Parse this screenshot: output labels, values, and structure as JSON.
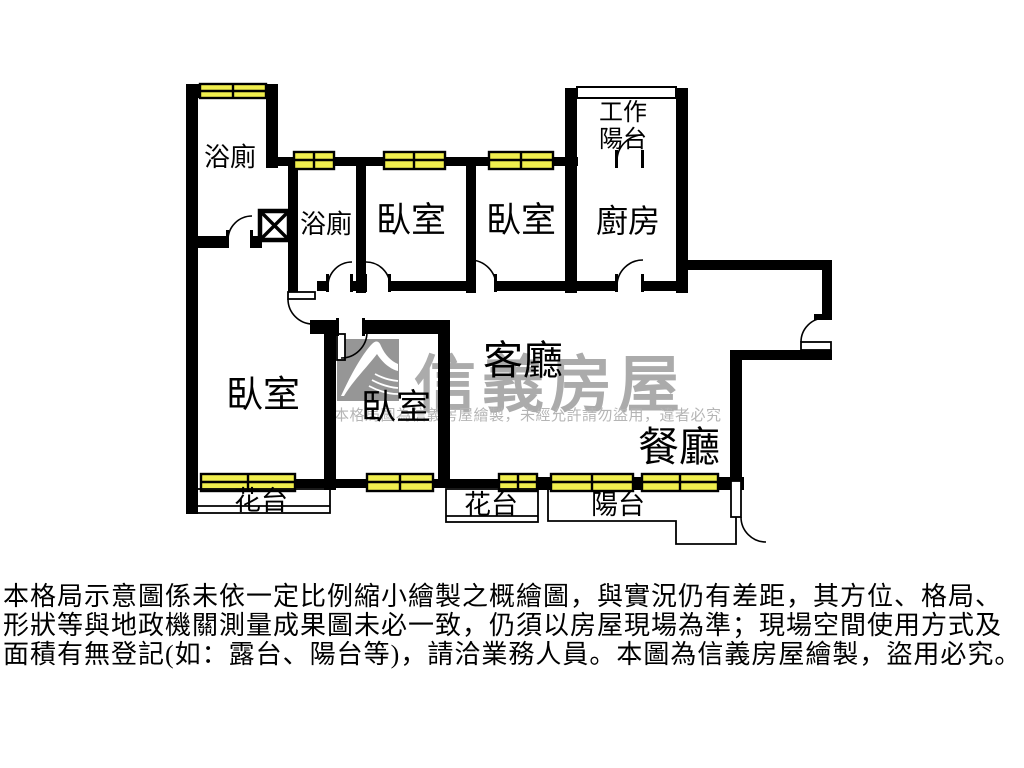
{
  "colors": {
    "wall": "#000000",
    "window_fill": "#f0ee4e",
    "logo_gray": "#969696",
    "watermark_gray": "#ababab",
    "notice_gray": "#b5b5b5",
    "text": "#000000",
    "bg": "#ffffff"
  },
  "rooms": {
    "bath_top": {
      "label": "浴廁"
    },
    "bath_small": {
      "label": "浴廁"
    },
    "bedroom_top_1": {
      "label": "臥室"
    },
    "bedroom_top_2": {
      "label": "臥室"
    },
    "kitchen": {
      "label": "廚房"
    },
    "work_balcony": {
      "label": "工作陽台"
    },
    "living": {
      "label": "客廳"
    },
    "dining": {
      "label": "餐廳"
    },
    "bedroom_left": {
      "label": "臥室"
    },
    "bedroom_mid": {
      "label": "臥室"
    },
    "flower_left": {
      "label": "花台"
    },
    "flower_mid": {
      "label": "花台"
    },
    "balcony": {
      "label": "陽台"
    }
  },
  "icons": {
    "shaft_icon": "x-box-shaft",
    "window_icon": "yellow-double-pane",
    "door_icon": "quarter-arc-swing",
    "logo_icon": "sinyi-swoosh"
  },
  "watermark": {
    "brand": "信義房屋",
    "notice": "本格局圖為信義房屋繪製，未經允許請勿盜用，違者必究"
  },
  "disclaimer": {
    "line1": "本格局示意圖係未依一定比例縮小繪製之概繪圖，與實況仍有差距，其方位、格局、",
    "line2": "形狀等與地政機關測量成果圖未必一致，仍須以房屋現場為準；現場空間使用方式及",
    "line3": "面積有無登記(如：露台、陽台等)，請洽業務人員。本圖為信義房屋繪製，盜用必究。"
  }
}
